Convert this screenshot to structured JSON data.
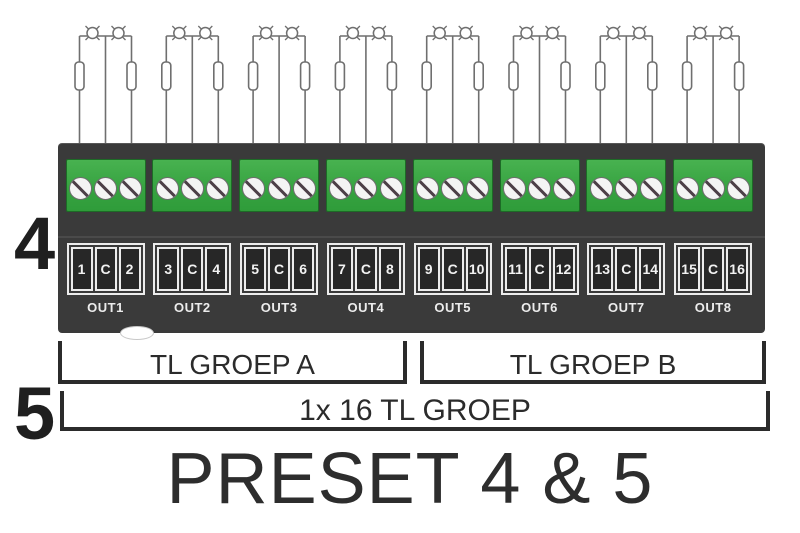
{
  "title": "PRESET 4 & 5",
  "labels": {
    "preset_top": "4",
    "preset_bottom": "5",
    "group_a": "TL GROEP A",
    "group_b": "TL GROEP B",
    "full_group": "1x 16 TL GROEP"
  },
  "outputs": [
    {
      "label": "OUT1",
      "terminals": [
        "1",
        "C",
        "2"
      ]
    },
    {
      "label": "OUT2",
      "terminals": [
        "3",
        "C",
        "4"
      ]
    },
    {
      "label": "OUT3",
      "terminals": [
        "5",
        "C",
        "6"
      ]
    },
    {
      "label": "OUT4",
      "terminals": [
        "7",
        "C",
        "8"
      ]
    },
    {
      "label": "OUT5",
      "terminals": [
        "9",
        "C",
        "10"
      ]
    },
    {
      "label": "OUT6",
      "terminals": [
        "11",
        "C",
        "12"
      ]
    },
    {
      "label": "OUT7",
      "terminals": [
        "13",
        "C",
        "14"
      ]
    },
    {
      "label": "OUT8",
      "terminals": [
        "15",
        "C",
        "16"
      ]
    }
  ],
  "icons": {
    "lamp": "lamp-icon",
    "ballast": "ballast-icon",
    "screw": "screw-icon"
  },
  "colors": {
    "background": "#ffffff",
    "device_body": "#3a3a3a",
    "terminal_green": "#37a341",
    "cell_background": "#272727",
    "cell_border": "#ececec",
    "wire": "#6f6f6f",
    "bracket_line": "#2b2b2b",
    "text_dark": "#2d2d2d",
    "text_light": "#f2f2f2"
  }
}
